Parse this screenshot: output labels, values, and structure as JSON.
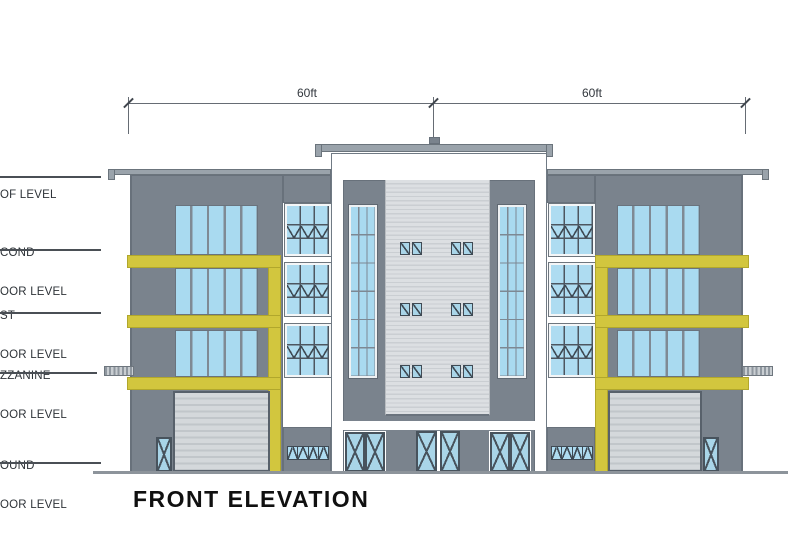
{
  "title": "FRONT ELEVATION",
  "dimension_line": {
    "left_span_label": "60ft",
    "right_span_label": "60ft"
  },
  "floor_levels": [
    {
      "id": "roof-level",
      "lines": [
        "OF LEVEL",
        ""
      ]
    },
    {
      "id": "second-floor-level",
      "lines": [
        "COND",
        "OOR LEVEL"
      ]
    },
    {
      "id": "first-floor-level",
      "lines": [
        "ST",
        "OOR LEVEL"
      ]
    },
    {
      "id": "mezzanine-floor-level",
      "lines": [
        "ZZANINE",
        "OOR LEVEL"
      ]
    },
    {
      "id": "ground-floor-level",
      "lines": [
        "OUND",
        "OOR LEVEL"
      ]
    }
  ],
  "colors": {
    "wall_gray": "#7a838d",
    "glass_blue": "#aadcf1",
    "accent_yellow": "#d2c63e",
    "siding_panel_gray": "#d7dadd",
    "roof_slab_gray": "#9aa3ab",
    "ground_line_gray": "#8d949b",
    "ink": "#2e3338"
  }
}
